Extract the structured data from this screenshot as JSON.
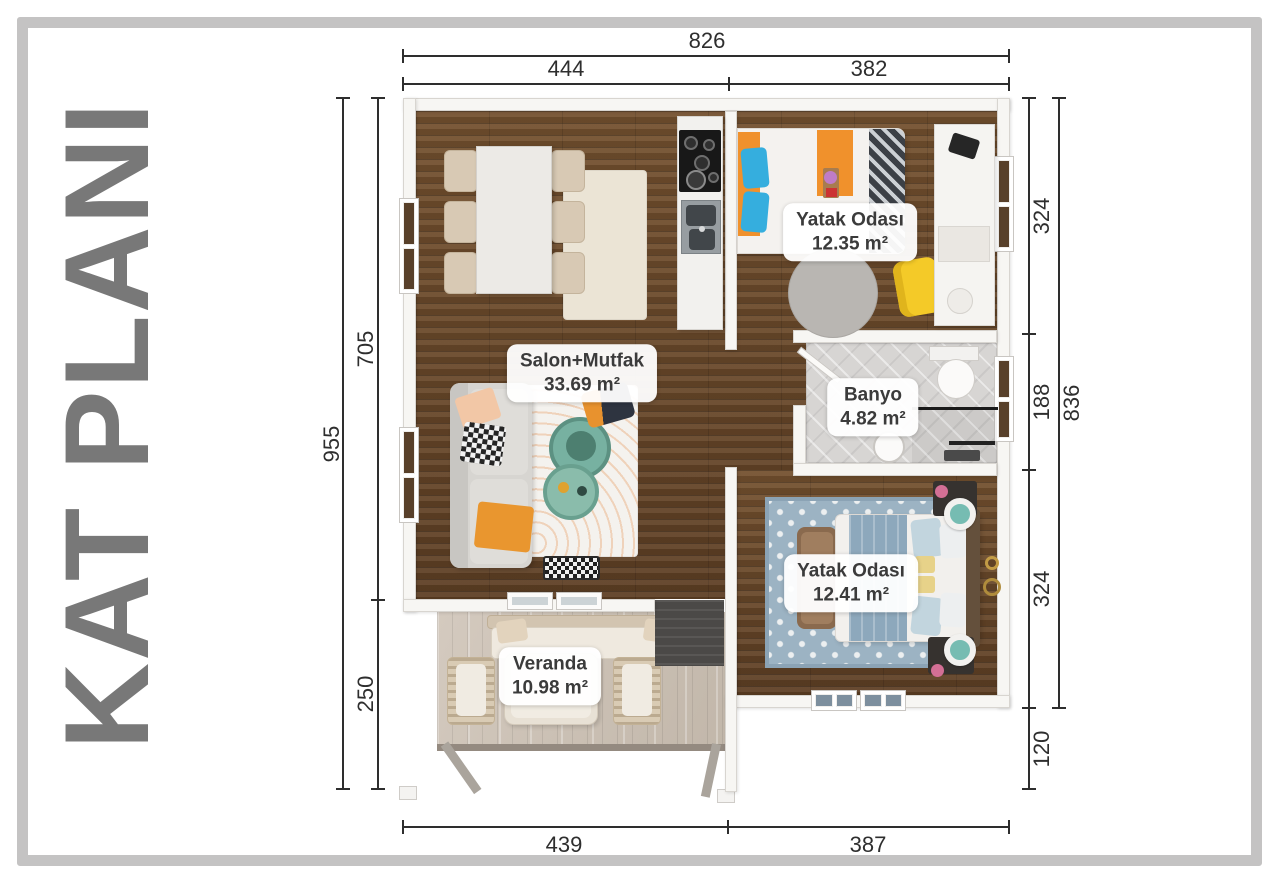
{
  "title": "KAT PLANI",
  "rooms": [
    {
      "name": "Yatak Odası",
      "area": "12.35 m²"
    },
    {
      "name": "Salon+Mutfak",
      "area": "33.69 m²"
    },
    {
      "name": "Banyo",
      "area": "4.82 m²"
    },
    {
      "name": "Yatak Odası",
      "area": "12.41 m²"
    },
    {
      "name": "Veranda",
      "area": "10.98 m²"
    }
  ],
  "dimensions": {
    "top": {
      "total": "826",
      "segments": [
        "444",
        "382"
      ]
    },
    "bottom": {
      "segments": [
        "439",
        "387"
      ]
    },
    "left": {
      "total": "955",
      "segments": [
        "705",
        "250"
      ]
    },
    "right": {
      "total": "836",
      "segments": [
        "324",
        "188",
        "324",
        "120"
      ]
    }
  },
  "colors": {
    "frame": "#c4c3c3",
    "title": "#787878",
    "dimension_text": "#2e2e2e",
    "wall": "#f7f6f3",
    "wood_floor": "#6b4a2d",
    "deck": "#cdc3b7",
    "tile": "#d7d5d3",
    "accent_orange": "#f0912c",
    "accent_teal": "#77b1a1",
    "accent_yellow": "#f4ca28",
    "accent_blue": "#35aede",
    "rug_blue": "#9cb3c3"
  }
}
